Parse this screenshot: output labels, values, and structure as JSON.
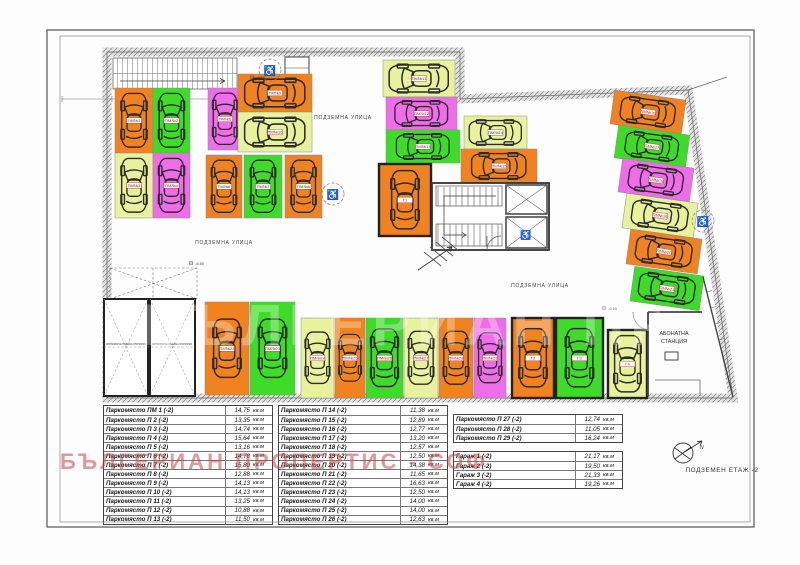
{
  "floor_label": "ПОДЗЕМЕН ЕТАЖ -2",
  "area_unit": "кв.м",
  "watermark": {
    "text": "БЪЛГЕРИАН ПРОПЕРТИС - СОФ",
    "color": "#c63e3e"
  },
  "compass_label": "N",
  "plan": {
    "street_label": "ПОДЗЕМНА УЛИЦА",
    "station_label_line1": "АБОНАТНА",
    "station_label_line2": "СТАНЦИЯ",
    "platform_label": "АВТОМОБИЛНА ПОДЕМНА ПЛАТФОРМА",
    "spot_label_prefix": "ПМ№",
    "elevation_label": "-6.60",
    "colors": {
      "orange": "#f0821f",
      "green": "#3edc28",
      "magenta": "#ef6de9",
      "yellow": "#e8f29c"
    },
    "spots": [
      {
        "n": "1",
        "c": "orange",
        "x": 115,
        "y": 88,
        "w": 38,
        "h": 65,
        "o": "v"
      },
      {
        "n": "2",
        "c": "green",
        "x": 153,
        "y": 88,
        "w": 37,
        "h": 65,
        "o": "v"
      },
      {
        "n": "3",
        "c": "yellow",
        "x": 115,
        "y": 153,
        "w": 38,
        "h": 65,
        "o": "v"
      },
      {
        "n": "4",
        "c": "magenta",
        "x": 153,
        "y": 153,
        "w": 37,
        "h": 65,
        "o": "v"
      },
      {
        "n": "5",
        "c": "magenta",
        "x": 208,
        "y": 88,
        "w": 34,
        "h": 62,
        "o": "v"
      },
      {
        "n": "6",
        "c": "orange",
        "x": 206,
        "y": 155,
        "w": 36,
        "h": 63,
        "o": "v"
      },
      {
        "n": "7",
        "c": "green",
        "x": 244,
        "y": 155,
        "w": 38,
        "h": 63,
        "o": "v"
      },
      {
        "n": "8",
        "c": "orange",
        "x": 285,
        "y": 155,
        "w": 37,
        "h": 63,
        "o": "v"
      },
      {
        "n": "9",
        "c": "orange",
        "x": 238,
        "y": 74,
        "w": 74,
        "h": 38,
        "o": "h"
      },
      {
        "n": "10",
        "c": "yellow",
        "x": 238,
        "y": 112,
        "w": 74,
        "h": 40,
        "o": "h"
      },
      {
        "n": "11",
        "c": "yellow",
        "x": 383,
        "y": 60,
        "w": 72,
        "h": 37,
        "o": "h"
      },
      {
        "n": "12",
        "c": "magenta",
        "x": 386,
        "y": 97,
        "w": 71,
        "h": 33,
        "o": "h"
      },
      {
        "n": "13",
        "c": "green",
        "x": 386,
        "y": 130,
        "w": 74,
        "h": 33,
        "o": "h"
      },
      {
        "n": "14",
        "c": "yellow",
        "x": 464,
        "y": 116,
        "w": 63,
        "h": 33,
        "o": "h"
      },
      {
        "n": "15",
        "c": "orange",
        "x": 461,
        "y": 149,
        "w": 76,
        "h": 34,
        "o": "h"
      },
      {
        "n": "16",
        "c": "orange",
        "x": 612,
        "y": 95,
        "w": 72,
        "h": 34,
        "o": "h",
        "r": 8
      },
      {
        "n": "17",
        "c": "green",
        "x": 616,
        "y": 130,
        "w": 72,
        "h": 33,
        "o": "h",
        "r": 8
      },
      {
        "n": "18",
        "c": "magenta",
        "x": 620,
        "y": 163,
        "w": 72,
        "h": 34,
        "o": "h",
        "r": 8
      },
      {
        "n": "19",
        "c": "yellow",
        "x": 624,
        "y": 198,
        "w": 72,
        "h": 35,
        "o": "h",
        "r": 8
      },
      {
        "n": "20",
        "c": "orange",
        "x": 628,
        "y": 234,
        "w": 72,
        "h": 35,
        "o": "h",
        "r": 8
      },
      {
        "n": "21",
        "c": "green",
        "x": 632,
        "y": 271,
        "w": 70,
        "h": 35,
        "o": "h",
        "r": 8
      },
      {
        "n": "22",
        "c": "orange",
        "x": 205,
        "y": 302,
        "w": 44,
        "h": 93,
        "o": "v"
      },
      {
        "n": "23",
        "c": "green",
        "x": 250,
        "y": 302,
        "w": 45,
        "h": 93,
        "o": "v"
      },
      {
        "n": "24",
        "c": "yellow",
        "x": 301,
        "y": 318,
        "w": 33,
        "h": 80,
        "o": "v"
      },
      {
        "n": "25",
        "c": "orange",
        "x": 335,
        "y": 318,
        "w": 30,
        "h": 80,
        "o": "v"
      },
      {
        "n": "26",
        "c": "green",
        "x": 366,
        "y": 318,
        "w": 37,
        "h": 80,
        "o": "v"
      },
      {
        "n": "27",
        "c": "yellow",
        "x": 404,
        "y": 318,
        "w": 34,
        "h": 80,
        "o": "v"
      },
      {
        "n": "28",
        "c": "orange",
        "x": 439,
        "y": 318,
        "w": 34,
        "h": 80,
        "o": "v"
      },
      {
        "n": "29",
        "c": "magenta",
        "x": 474,
        "y": 318,
        "w": 32,
        "h": 80,
        "o": "v"
      },
      {
        "n": "Г1",
        "c": "orange",
        "x": 379,
        "y": 164,
        "w": 52,
        "h": 72,
        "o": "v",
        "g": true
      },
      {
        "n": "Г2",
        "c": "orange",
        "x": 512,
        "y": 318,
        "w": 42,
        "h": 80,
        "o": "v",
        "g": true
      },
      {
        "n": "Г3",
        "c": "green",
        "x": 556,
        "y": 318,
        "w": 47,
        "h": 80,
        "o": "v",
        "g": true
      },
      {
        "n": "Г4",
        "c": "yellow",
        "x": 608,
        "y": 330,
        "w": 39,
        "h": 68,
        "o": "v",
        "g": true
      }
    ]
  },
  "tables": [
    {
      "x": 103,
      "y": 405,
      "w": 170,
      "rows": [
        {
          "label": "Паркомясто ПМ 1 (-2)",
          "area": "14,75"
        },
        {
          "label": "Паркомясто П 2 (-2)",
          "area": "13,35"
        },
        {
          "label": "Паркомясто П 3 (-2)",
          "area": "14,74"
        },
        {
          "label": "Паркомясто П 4 (-2)",
          "area": "15,64"
        },
        {
          "label": "Паркомясто П 5 (-2)",
          "area": "13,16"
        },
        {
          "label": "Паркомясто П 6 (-2)",
          "area": "14,78"
        },
        {
          "label": "Паркомясто П 7 (-2)",
          "area": "15,80"
        },
        {
          "label": "Паркомясто П 8 (-2)",
          "area": "12,88"
        },
        {
          "label": "Паркомясто П 9 (-2)",
          "area": "14,13"
        },
        {
          "label": "Паркомясто П 10 (-2)",
          "area": "14,13"
        },
        {
          "label": "Паркомясто П 11 (-2)",
          "area": "13,25"
        },
        {
          "label": "Паркомясто П 12 (-2)",
          "area": "10,88"
        },
        {
          "label": "Паркомясто П 13 (-2)",
          "area": "11,50"
        }
      ]
    },
    {
      "x": 278,
      "y": 405,
      "w": 170,
      "rows": [
        {
          "label": "Паркомясто П 14 (-2)",
          "area": "11,38"
        },
        {
          "label": "Паркомясто П 15 (-2)",
          "area": "12,89"
        },
        {
          "label": "Паркомясто П 16 (-2)",
          "area": "12,77"
        },
        {
          "label": "Паркомясто П 17 (-2)",
          "area": "13,20"
        },
        {
          "label": "Паркомясто П 18 (-2)",
          "area": "12,57"
        },
        {
          "label": "Паркомясто П 19 (-2)",
          "area": "12,50"
        },
        {
          "label": "Паркомясто П 20 (-2)",
          "area": "14,38"
        },
        {
          "label": "Паркомясто П 21 (-2)",
          "area": "11,65"
        },
        {
          "label": "Паркомясто П 22 (-2)",
          "area": "16,63"
        },
        {
          "label": "Паркомясто П 23 (-2)",
          "area": "12,50"
        },
        {
          "label": "Паркомясто П 24 (-2)",
          "area": "14,00"
        },
        {
          "label": "Паркомясто П 25 (-2)",
          "area": "14,00"
        },
        {
          "label": "Паркомясто П 26 (-2)",
          "area": "12,63"
        }
      ]
    },
    {
      "x": 453,
      "y": 414,
      "w": 170,
      "rows": [
        {
          "label": "Паркомясто П 27 (-2)",
          "area": "12,74"
        },
        {
          "label": "Паркомясто П 28 (-2)",
          "area": "11,05"
        },
        {
          "label": "Паркомясто П 29 (-2)",
          "area": "16,24"
        }
      ]
    },
    {
      "x": 453,
      "y": 451,
      "w": 170,
      "rows": [
        {
          "label": "Гараж 1 (-2)",
          "area": "21,17"
        },
        {
          "label": "Гараж 2 (-2)",
          "area": "19,50"
        },
        {
          "label": "Гараж 3 (-2)",
          "area": "21,33"
        },
        {
          "label": "Гараж 4 (-2)",
          "area": "19,26"
        }
      ]
    }
  ]
}
